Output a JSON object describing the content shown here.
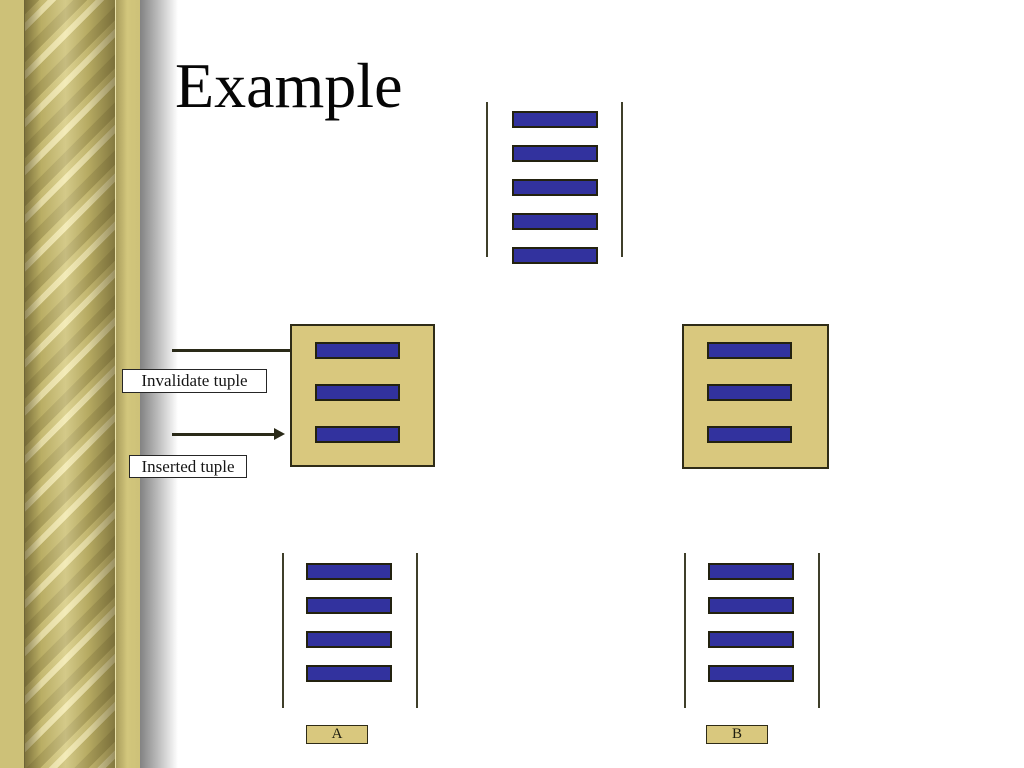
{
  "slide": {
    "title": "Example",
    "labels": {
      "invalidate": "Invalidate tuple",
      "inserted": "Inserted tuple"
    },
    "groups": {
      "top_view": {
        "bars": 5
      },
      "middle_left_box": {
        "bars": 3
      },
      "middle_right_box": {
        "bars": 3
      },
      "bottom_left_table": {
        "bars": 4,
        "caption": "A"
      },
      "bottom_right_table": {
        "bars": 4,
        "caption": "B"
      }
    },
    "colors": {
      "bar_fill": "#32329e",
      "box_fill": "#d9c87e",
      "gold_border": "#cdc178"
    }
  }
}
